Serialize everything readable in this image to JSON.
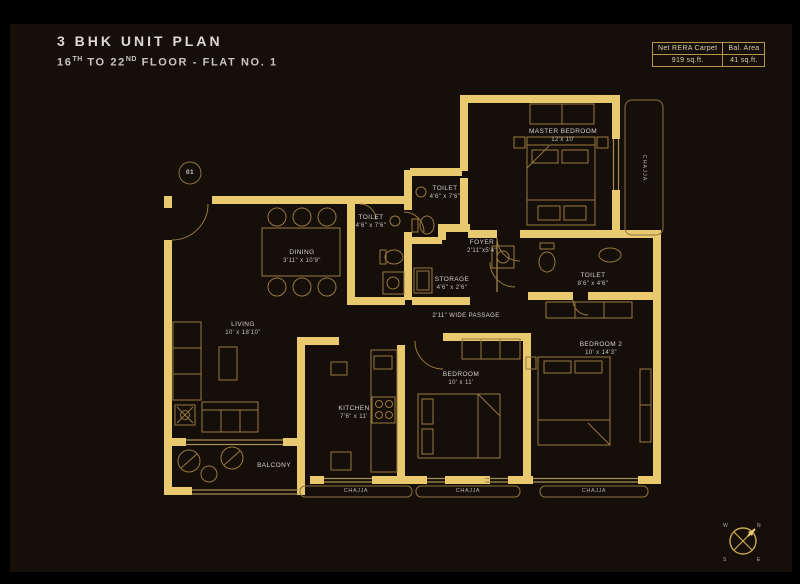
{
  "header": {
    "title": "3 BHK UNIT PLAN",
    "subtitle": {
      "floor_from": "16",
      "floor_from_sup": "TH",
      "mid": " TO 22",
      "mid_sup": "ND",
      "rest": " FLOOR - FLAT NO. 1"
    }
  },
  "area_table": {
    "columns": [
      {
        "header": "Net RERA Carpet",
        "value": "919 sq.ft."
      },
      {
        "header": "Bal. Area",
        "value": "41 sq.ft."
      }
    ]
  },
  "plan": {
    "unit_marker": "01",
    "rooms": {
      "master_bedroom": {
        "name": "MASTER BEDROOM",
        "dims": "12'x 10'"
      },
      "toilet_top": {
        "name": "TOILET",
        "dims": "4'6\" x 7'6\""
      },
      "toilet_mid": {
        "name": "TOILET",
        "dims": "4'6\" x 7'6\""
      },
      "dining": {
        "name": "DINING",
        "dims": "3'11\" x 10'9\""
      },
      "foyer": {
        "name": "FOYER",
        "dims": "2'11\"x5'4\""
      },
      "storage": {
        "name": "STORAGE",
        "dims": "4'6\" x 2'6\""
      },
      "toilet_right": {
        "name": "TOILET",
        "dims": "8'6\" x 4'6\""
      },
      "passage": {
        "name": "2'11\" WIDE PASSAGE"
      },
      "living": {
        "name": "LIVING",
        "dims": "10' x 18'10\""
      },
      "kitchen": {
        "name": "KITCHEN",
        "dims": "7'6\" x 11'"
      },
      "bedroom": {
        "name": "BEDROOM",
        "dims": "10' x 11'"
      },
      "bedroom2": {
        "name": "BEDROOM 2",
        "dims": "10' x 14'3\""
      },
      "balcony": {
        "name": "BALCONY"
      }
    },
    "chajja_right": "CHAJJA",
    "chajja_bottom_1": "CHAJJA",
    "chajja_bottom_2": "CHAJJA",
    "chajja_bottom_3": "CHAJJA",
    "compass": {
      "n": "N",
      "e": "E",
      "s": "S",
      "w": "W"
    }
  },
  "colors": {
    "background": "#150e09",
    "wall_gold": "#e9c96e",
    "thin_line": "#a98f55",
    "furniture_line": "#97793f",
    "label_text": "#d6d2cd",
    "table_border": "#b6964a"
  }
}
